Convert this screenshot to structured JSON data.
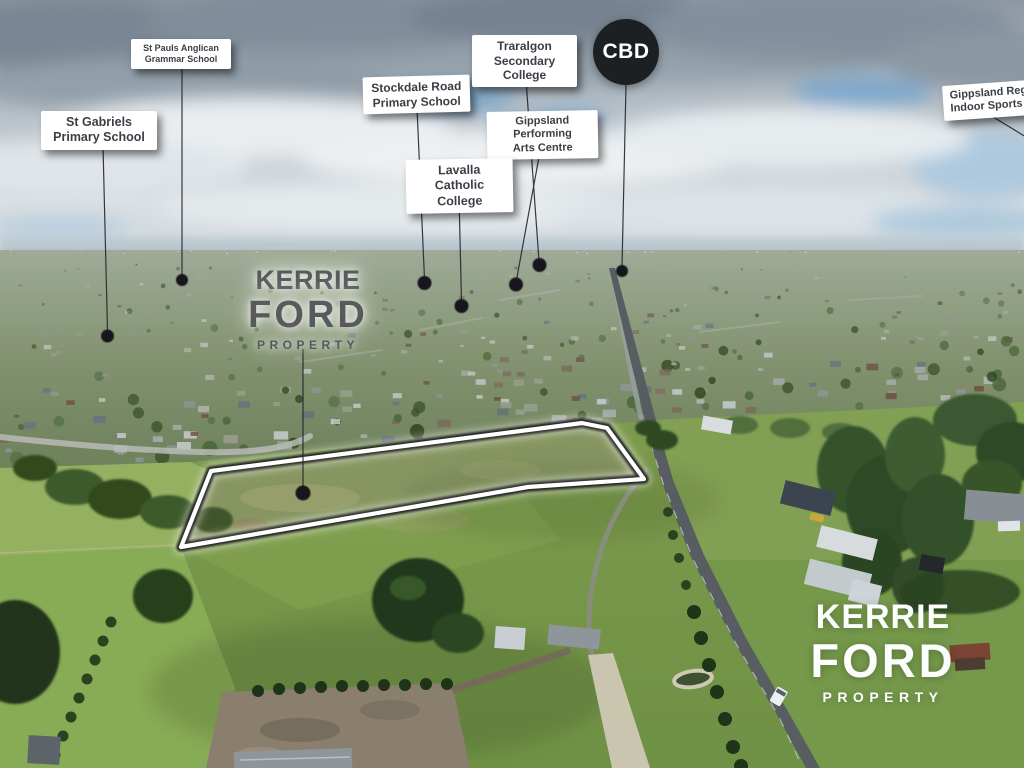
{
  "brand": {
    "line1": "KERRIE",
    "line2": "FORD",
    "line3": "PROPERTY"
  },
  "badges": {
    "cbd": "CBD"
  },
  "labels": {
    "st_pauls": {
      "line1": "St Pauls Anglican",
      "line2": "Grammar School"
    },
    "st_gabriels": {
      "line1": "St Gabriels",
      "line2": "Primary School"
    },
    "stockdale": {
      "line1": "Stockdale Road",
      "line2": "Primary School"
    },
    "traralgon": {
      "line1": "Traralgon",
      "line2": "Secondary College"
    },
    "arts_centre": {
      "line1": "Gippsland Performing",
      "line2": "Arts Centre"
    },
    "lavalla": {
      "line1": "Lavalla",
      "line2": "Catholic College"
    },
    "stadium": {
      "line1": "Gippsland Regio",
      "line2": "Indoor Sports Sta"
    }
  },
  "colors": {
    "boundary_white": "#ffffff",
    "boundary_black": "#111111",
    "cbd_badge_bg": "#1d2023",
    "label_bg": "#ffffff",
    "label_text": "#3a3f45"
  }
}
